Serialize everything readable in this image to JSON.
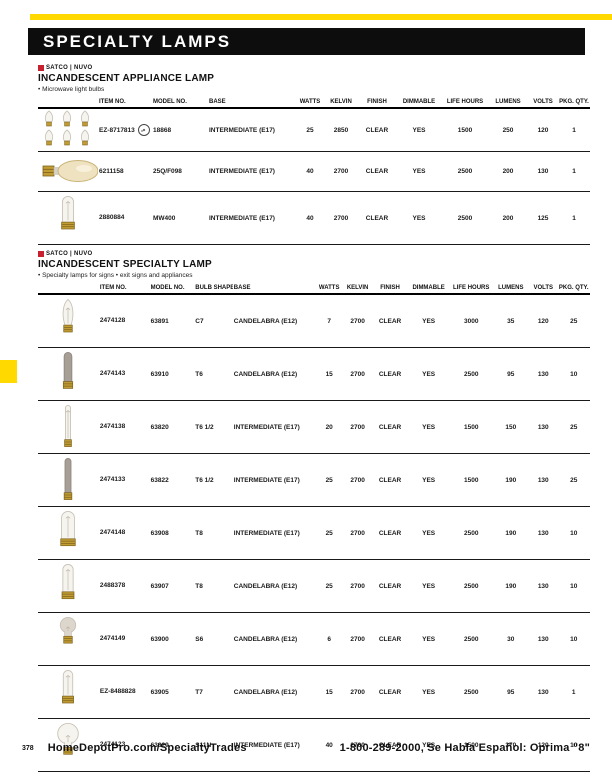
{
  "page": {
    "title": "SPECIALTY LAMPS",
    "accent_yellow": "#ffd900",
    "brand_red": "#c8202f"
  },
  "footer": {
    "page_number": "378",
    "website": "HomeDepotPro.com/SpecialtyTrades",
    "phone_line": "1-800-289-2000, Se Habla Español: Oprima \"8\""
  },
  "sections": [
    {
      "brand": "SATCO | NUVO",
      "heading": "INCANDESCENT APPLIANCE LAMP",
      "bullet": "• Microwave light bulbs",
      "columns": [
        {
          "key": "img",
          "label": "",
          "align": "al-c"
        },
        {
          "key": "item",
          "label": "ITEM NO.",
          "align": "al-l"
        },
        {
          "key": "model",
          "label": "MODEL NO.",
          "align": "al-l"
        },
        {
          "key": "base",
          "label": "BASE",
          "align": "al-l"
        },
        {
          "key": "watts",
          "label": "WATTS",
          "align": "al-c"
        },
        {
          "key": "kelvin",
          "label": "KELVIN",
          "align": "al-c"
        },
        {
          "key": "finish",
          "label": "FINISH",
          "align": "al-c"
        },
        {
          "key": "dimmable",
          "label": "DIMMABLE",
          "align": "al-c"
        },
        {
          "key": "life_hours",
          "label": "LIFE HOURS",
          "align": "al-c"
        },
        {
          "key": "lumens",
          "label": "LUMENS",
          "align": "al-c"
        },
        {
          "key": "volts",
          "label": "VOLTS",
          "align": "al-c"
        },
        {
          "key": "pkg_qty",
          "label": "PKG. QTY.",
          "align": "al-c"
        }
      ],
      "col_widths": [
        60,
        54,
        56,
        88,
        28,
        34,
        38,
        46,
        46,
        40,
        30,
        32
      ],
      "rows": [
        {
          "img": "mini-bulb-six-pack",
          "item": "EZ-8717813",
          "badge": true,
          "model": "18868",
          "base": "INTERMEDIATE (E17)",
          "watts": "25",
          "kelvin": "2850",
          "finish": "CLEAR",
          "dimmable": "YES",
          "life_hours": "1500",
          "lumens": "250",
          "volts": "120",
          "pkg_qty": "1"
        },
        {
          "img": "horizontal-amber-bulb",
          "item": "6211158",
          "model": "25Q/F098",
          "base": "INTERMEDIATE (E17)",
          "watts": "40",
          "kelvin": "2700",
          "finish": "CLEAR",
          "dimmable": "YES",
          "life_hours": "2500",
          "lumens": "200",
          "volts": "130",
          "pkg_qty": "1"
        },
        {
          "img": "appliance-tube-bulb",
          "item": "2880884",
          "model": "MW400",
          "base": "INTERMEDIATE (E17)",
          "watts": "40",
          "kelvin": "2700",
          "finish": "CLEAR",
          "dimmable": "YES",
          "life_hours": "2500",
          "lumens": "200",
          "volts": "125",
          "pkg_qty": "1"
        }
      ]
    },
    {
      "brand": "SATCO | NUVO",
      "heading": "INCANDESCENT SPECIALTY LAMP",
      "bullet": "• Specialty lamps for signs • exit signs and appliances",
      "columns": [
        {
          "key": "img",
          "label": "",
          "align": "al-c"
        },
        {
          "key": "item",
          "label": "ITEM NO.",
          "align": "al-l"
        },
        {
          "key": "model",
          "label": "MODEL NO.",
          "align": "al-l"
        },
        {
          "key": "bulb_shape",
          "label": "BULB SHAPE",
          "align": "al-l"
        },
        {
          "key": "base",
          "label": "BASE",
          "align": "al-l"
        },
        {
          "key": "watts",
          "label": "WATTS",
          "align": "al-c"
        },
        {
          "key": "kelvin",
          "label": "KELVIN",
          "align": "al-c"
        },
        {
          "key": "finish",
          "label": "FINISH",
          "align": "al-c"
        },
        {
          "key": "dimmable",
          "label": "DIMMABLE",
          "align": "al-c"
        },
        {
          "key": "life_hours",
          "label": "LIFE HOURS",
          "align": "al-c"
        },
        {
          "key": "lumens",
          "label": "LUMENS",
          "align": "al-c"
        },
        {
          "key": "volts",
          "label": "VOLTS",
          "align": "al-c"
        },
        {
          "key": "pkg_qty",
          "label": "PKG. QTY.",
          "align": "al-c"
        }
      ],
      "col_widths": [
        60,
        50,
        44,
        38,
        82,
        26,
        30,
        34,
        42,
        42,
        36,
        28,
        32
      ],
      "rows": [
        {
          "img": "c7-torpedo",
          "item": "2474128",
          "model": "63891",
          "bulb_shape": "C7",
          "base": "CANDELABRA (E12)",
          "watts": "7",
          "kelvin": "2700",
          "finish": "CLEAR",
          "dimmable": "YES",
          "life_hours": "3000",
          "lumens": "35",
          "volts": "120",
          "pkg_qty": "25"
        },
        {
          "img": "t6-gray-tube",
          "item": "2474143",
          "model": "63910",
          "bulb_shape": "T6",
          "base": "CANDELABRA (E12)",
          "watts": "15",
          "kelvin": "2700",
          "finish": "CLEAR",
          "dimmable": "YES",
          "life_hours": "2500",
          "lumens": "95",
          "volts": "130",
          "pkg_qty": "10"
        },
        {
          "img": "t65-thin-tube",
          "item": "2474138",
          "model": "63820",
          "bulb_shape": "T6 1/2",
          "base": "INTERMEDIATE (E17)",
          "watts": "20",
          "kelvin": "2700",
          "finish": "CLEAR",
          "dimmable": "YES",
          "life_hours": "1500",
          "lumens": "150",
          "volts": "130",
          "pkg_qty": "25"
        },
        {
          "img": "t65-gray-thin-tube",
          "item": "2474133",
          "model": "63822",
          "bulb_shape": "T6 1/2",
          "base": "INTERMEDIATE (E17)",
          "watts": "25",
          "kelvin": "2700",
          "finish": "CLEAR",
          "dimmable": "YES",
          "life_hours": "1500",
          "lumens": "190",
          "volts": "130",
          "pkg_qty": "25"
        },
        {
          "img": "t8-wide-tube",
          "item": "2474148",
          "model": "63908",
          "bulb_shape": "T8",
          "base": "INTERMEDIATE (E17)",
          "watts": "25",
          "kelvin": "2700",
          "finish": "CLEAR",
          "dimmable": "YES",
          "life_hours": "2500",
          "lumens": "190",
          "volts": "130",
          "pkg_qty": "10"
        },
        {
          "img": "t8-tube",
          "item": "2488378",
          "model": "63907",
          "bulb_shape": "T8",
          "base": "CANDELABRA (E12)",
          "watts": "25",
          "kelvin": "2700",
          "finish": "CLEAR",
          "dimmable": "YES",
          "life_hours": "2500",
          "lumens": "190",
          "volts": "130",
          "pkg_qty": "10"
        },
        {
          "img": "s6-round",
          "item": "2474149",
          "model": "63900",
          "bulb_shape": "S6",
          "base": "CANDELABRA (E12)",
          "watts": "6",
          "kelvin": "2700",
          "finish": "CLEAR",
          "dimmable": "YES",
          "life_hours": "2500",
          "lumens": "30",
          "volts": "130",
          "pkg_qty": "10"
        },
        {
          "img": "t7-tube",
          "item": "EZ-8488828",
          "model": "63905",
          "bulb_shape": "T7",
          "base": "CANDELABRA (E12)",
          "watts": "15",
          "kelvin": "2700",
          "finish": "CLEAR",
          "dimmable": "YES",
          "life_hours": "2500",
          "lumens": "95",
          "volts": "130",
          "pkg_qty": "1"
        },
        {
          "img": "s11-round",
          "item": "2474123",
          "model": "63829",
          "bulb_shape": "S11N",
          "base": "INTERMEDIATE (E17)",
          "watts": "40",
          "kelvin": "2700",
          "finish": "CLEAR",
          "dimmable": "YES",
          "life_hours": "1500",
          "lumens": "370",
          "volts": "120",
          "pkg_qty": "10"
        }
      ]
    }
  ]
}
